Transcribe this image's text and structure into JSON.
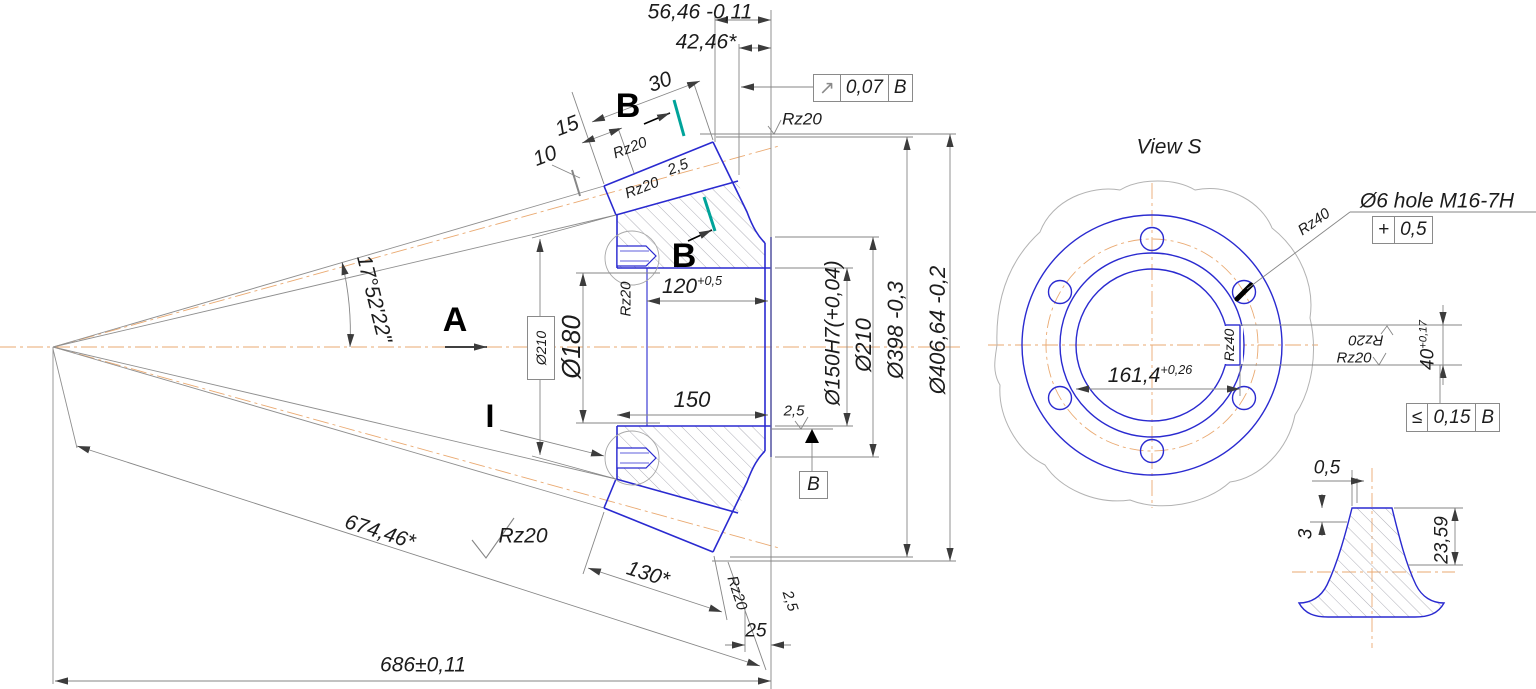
{
  "colors": {
    "part_line": "#2a2ad0",
    "dim_line": "#868686",
    "centerline": "#eaaa72",
    "section_tick": "#00a39a"
  },
  "main_view": {
    "section_label": "B",
    "view_label": "A",
    "detail_label": "I",
    "datum_label": "B",
    "dims": {
      "back_width": "56,46 -0,11",
      "back_width_ref": "42,46*",
      "face_30": "30",
      "face_15": "15",
      "face_10": "10",
      "chamfer_face": "2,5",
      "cone_angle": "17°52'22\"",
      "hub_od_ref": "Ø210",
      "holes_pcd": "Ø180",
      "bore_len": {
        "value": "120",
        "tol": "+0,5"
      },
      "hub_len": "150",
      "bore_dia": "Ø150H7(+0,04)",
      "rim_od": "Ø210",
      "tip_od": "Ø398 -0,3",
      "theor_od": "Ø406,64 -0,2",
      "cone_dist": "674,46*",
      "face_width": "130*",
      "back_offset": "25",
      "overall": "686±0,11",
      "chamfer_back": "2,5",
      "chamfer_rim": "2,5"
    },
    "roughness": {
      "rz20": "Rz20"
    },
    "runout_frame": {
      "symbol": "↗",
      "value": "0,07",
      "datum": "B"
    }
  },
  "view_s": {
    "title": "View S",
    "hole_note": "Ø6 hole M16-7H",
    "position_frame": {
      "symbol": "+",
      "value": "0,5"
    },
    "roughness": {
      "rz40": "Rz40",
      "rz20": "Rz20"
    },
    "keyway_width": {
      "value": "40",
      "tol": "+0,17"
    },
    "bore_keyway": {
      "value": "161,4",
      "tol": "+0,26"
    },
    "symmetry_frame": {
      "symbol": "≤",
      "value": "0,15",
      "datum": "B"
    }
  },
  "tooth_detail": {
    "tip_flat": "0,5",
    "addendum_ref": "3",
    "tooth_height": "23,59"
  }
}
